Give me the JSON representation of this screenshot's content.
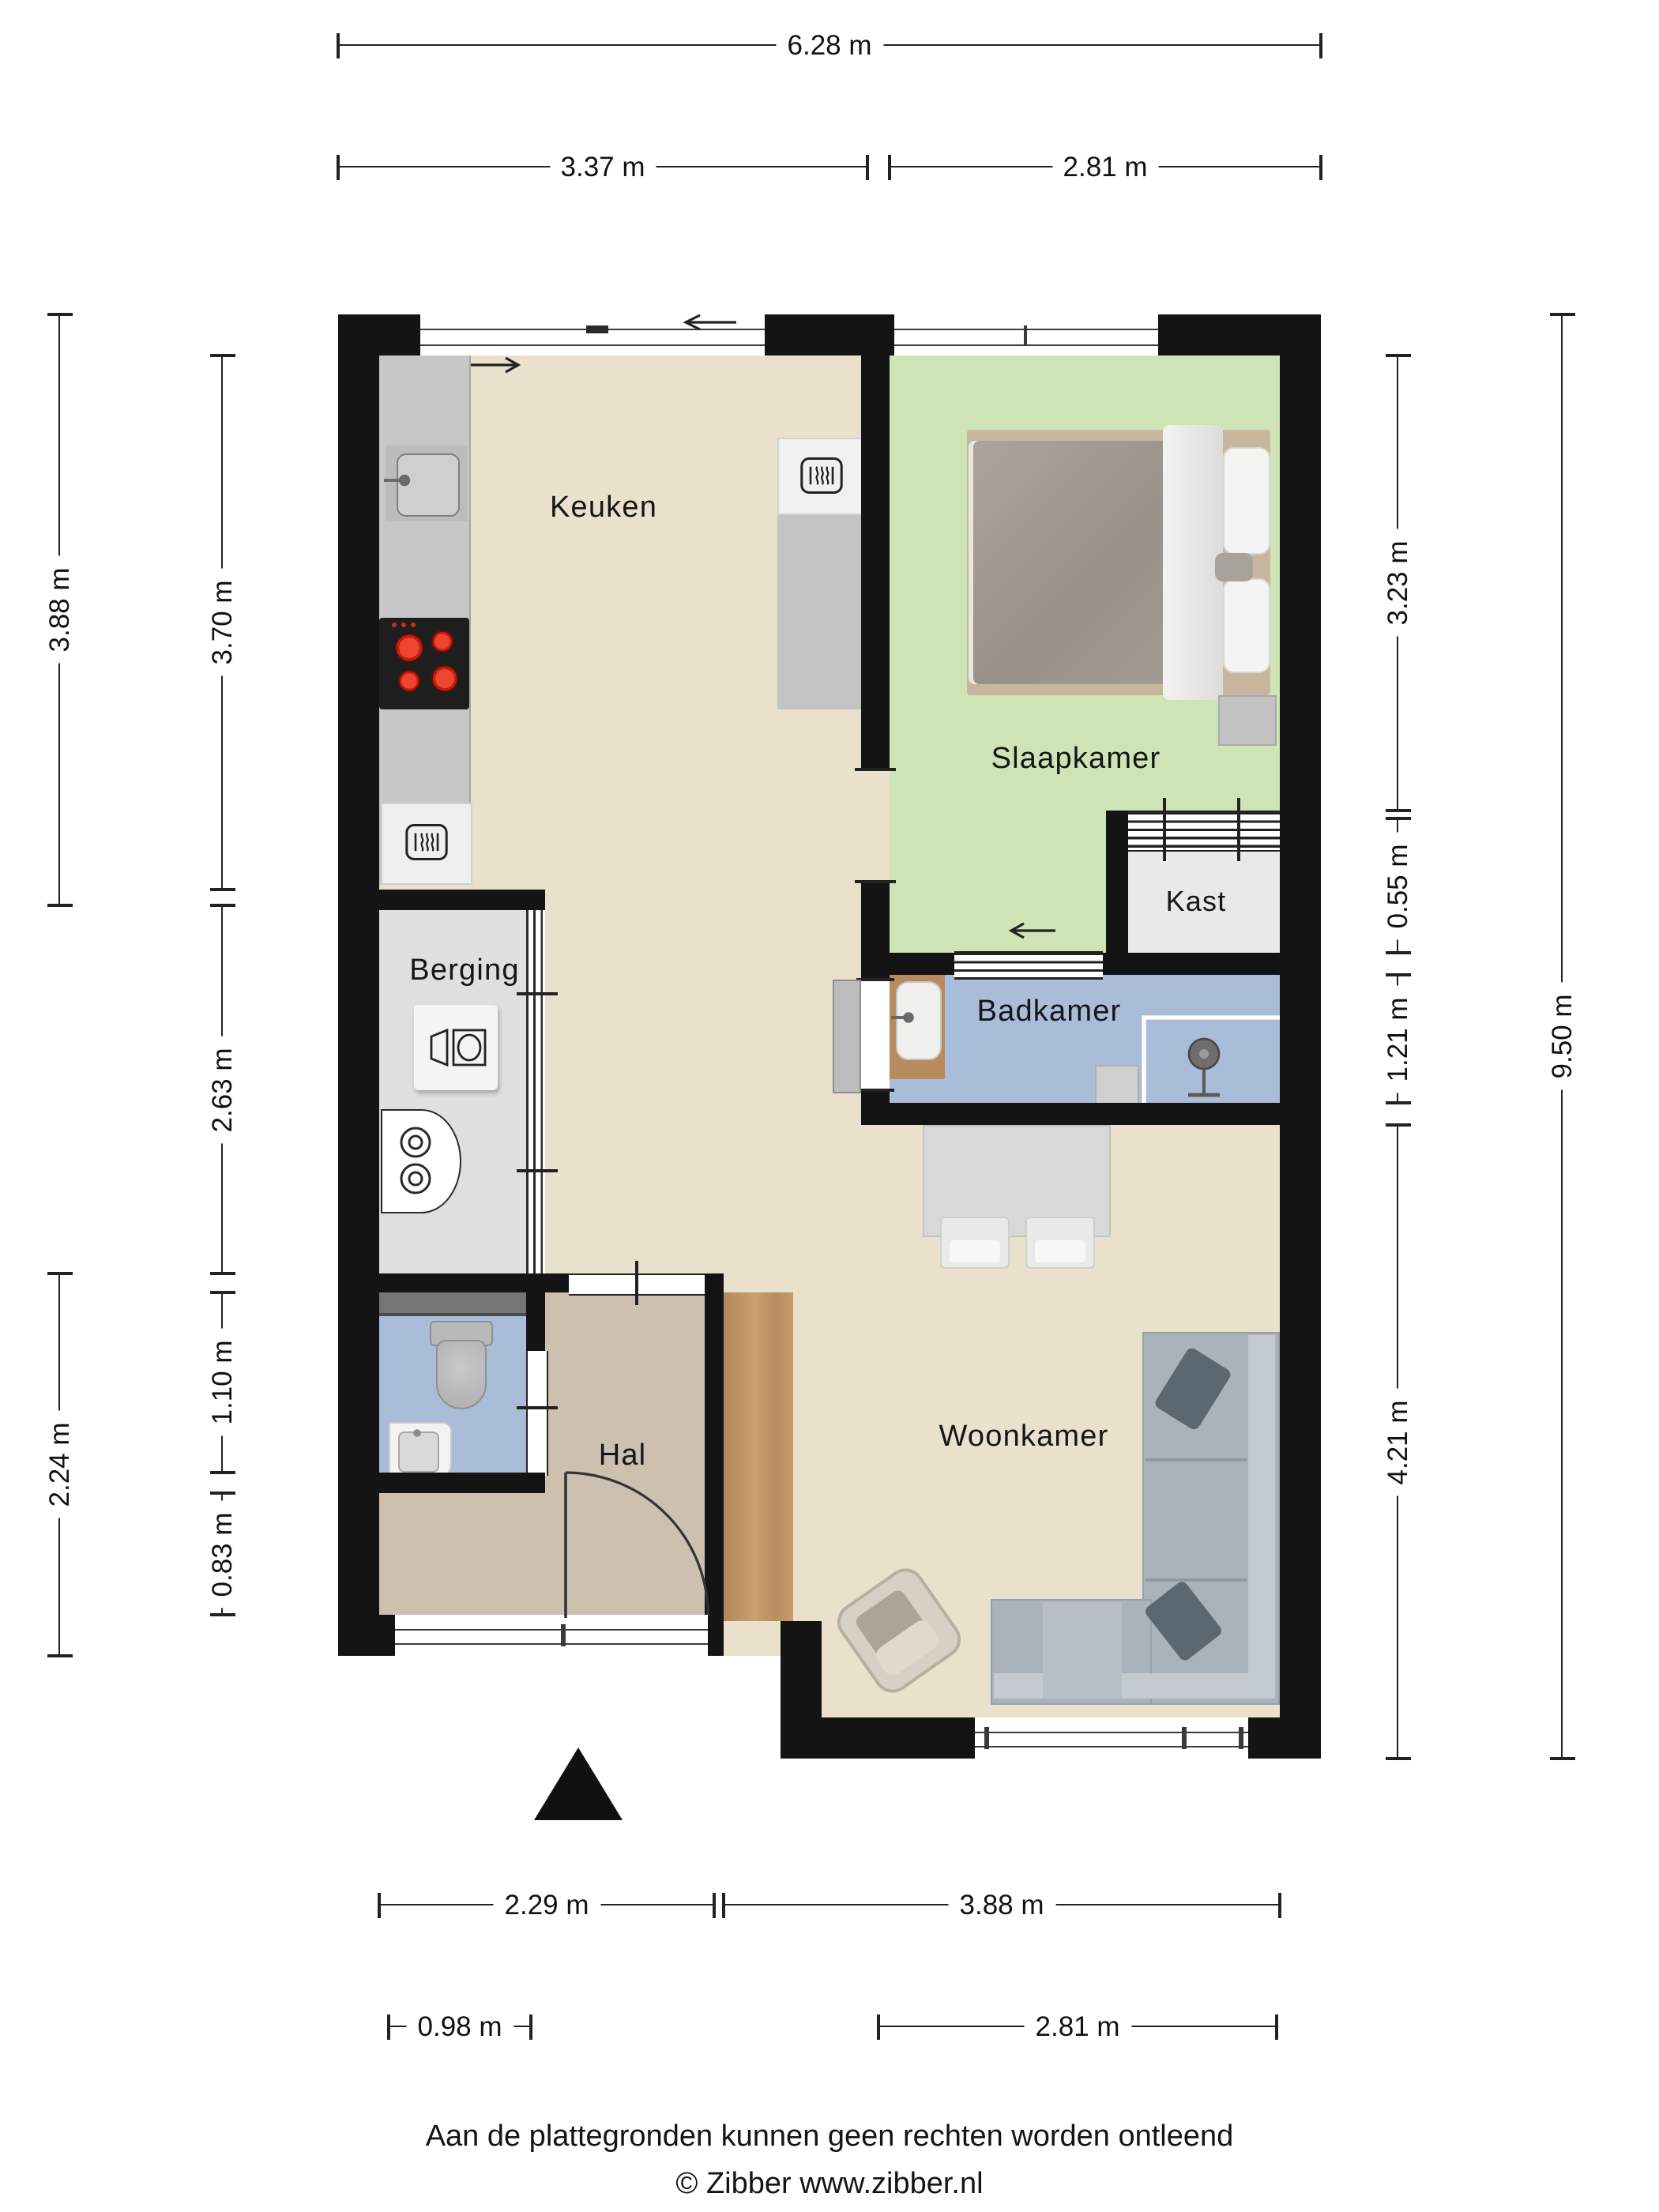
{
  "rooms": {
    "keuken": "Keuken",
    "slaapkamer": "Slaapkamer",
    "kast": "Kast",
    "badkamer": "Badkamer",
    "berging": "Berging",
    "hal": "Hal",
    "woonkamer": "Woonkamer"
  },
  "dimensions": {
    "top_total": "6.28 m",
    "top_left": "3.37 m",
    "top_right": "2.81 m",
    "left_outer_upper": "3.88 m",
    "left_outer_lower": "2.24 m",
    "left_inner_keuken": "3.70 m",
    "left_inner_berging": "2.63 m",
    "left_inner_toilet": "1.10 m",
    "left_inner_hal": "0.83 m",
    "right_inner_slaapkamer": "3.23 m",
    "right_inner_kast": "0.55 m",
    "right_inner_badkamer": "1.21 m",
    "right_inner_woonkamer": "4.21 m",
    "right_outer_total": "9.50 m",
    "bottom_hal": "2.29 m",
    "bottom_woonkamer": "3.88 m",
    "bottom_berging": "0.98 m",
    "bottom_window": "2.81 m"
  },
  "footer": {
    "disclaimer": "Aan de plattegronden kunnen geen rechten worden ontleend",
    "copyright": "© Zibber www.zibber.nl"
  },
  "colors": {
    "wall": "#141414",
    "living_floor": "#e9e1cb",
    "bedroom_floor": "#cfe4b5",
    "bathroom_floor": "#a9bdd9",
    "storage_floor": "#dfdfdf",
    "closet_floor": "#e9e9e9",
    "hall_floor": "#cec0af",
    "wardrobe_wood": "#bf9264",
    "stove_burner": "#d6281c",
    "sofa": "#a9b3bb"
  }
}
